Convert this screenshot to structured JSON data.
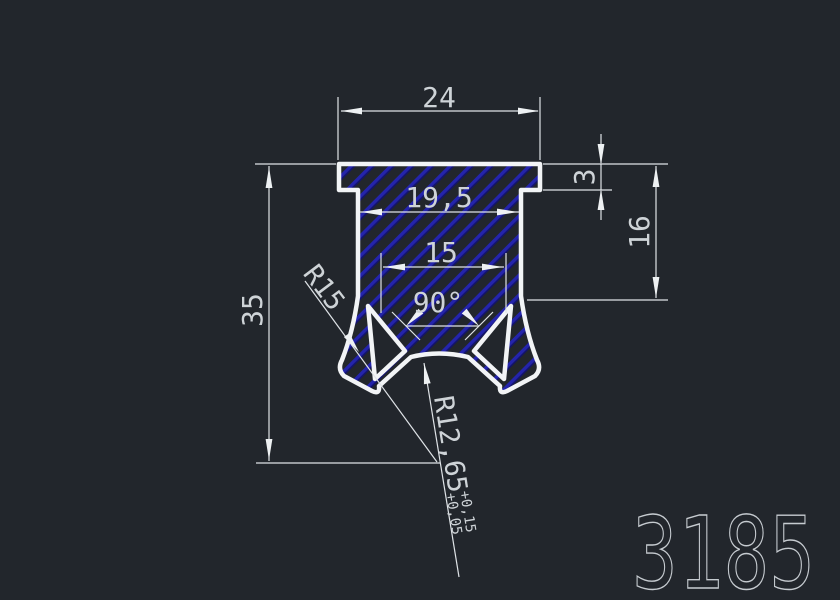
{
  "window": {
    "type": "cad-drawing-view",
    "background": "#22262c"
  },
  "part_number": "3185",
  "dimensions": {
    "top_width": "24",
    "body_width": "19,5",
    "groove_width": "15",
    "groove_angle": "90°",
    "flange_thickness": "3",
    "side_depth": "16",
    "total_height": "35",
    "leg_radius": "R15",
    "bottom_radius": "R12,65",
    "bottom_radius_tol_upper": "+0,15",
    "bottom_radius_tol_lower": "+0,05"
  },
  "colors": {
    "background": "#22262c",
    "profile_outline": "#f2f4f6",
    "hatch_primary": "#2424ac",
    "hatch_shadow": "#12126e",
    "dimension_lines": "#dfe3e7",
    "dimension_text": "#ced3d7",
    "part_number_outline": "#c6cbd0"
  }
}
